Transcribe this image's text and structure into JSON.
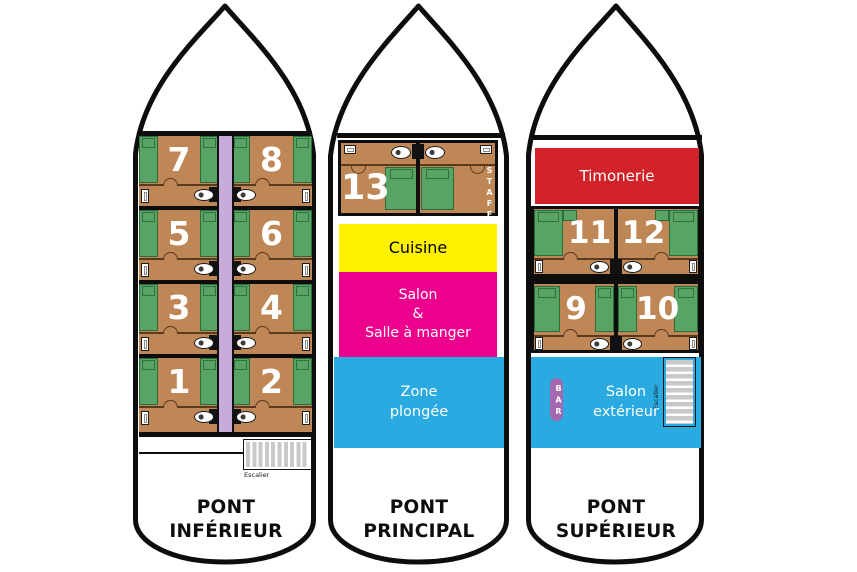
{
  "colors": {
    "floor": "#BF8755",
    "bed": "#57A464",
    "corridor": "#C7ABD9",
    "kitchen": "#FFF200",
    "salon": "#EC008C",
    "water": "#29ABE2",
    "wheelhouse": "#D2232A",
    "bar": "#A468B0",
    "stair": "#C9C9C9",
    "outline": "#0D0D0D"
  },
  "decks": [
    {
      "title": "PONT INFÉRIEUR",
      "stairs": "Escalier",
      "rows": [
        {
          "l": "7",
          "r": "8"
        },
        {
          "l": "5",
          "r": "6"
        },
        {
          "l": "3",
          "r": "4"
        },
        {
          "l": "1",
          "r": "2"
        }
      ]
    },
    {
      "title": "PONT PRINCIPAL",
      "cabin": "13",
      "cabin_tag": "STAFF",
      "kitchen": "Cuisine",
      "salon": "Salon\n&\nSalle à manger",
      "dive_zone": "Zone\nplongée"
    },
    {
      "title": "PONT SUPÉRIEUR",
      "wheelhouse": "Timonerie",
      "rows": [
        {
          "l": "11",
          "r": "12"
        },
        {
          "l": "9",
          "r": "10"
        }
      ],
      "bar": "BAR",
      "outdoor_salon": "Salon\nextérieur",
      "stairs": "Escalier"
    }
  ]
}
